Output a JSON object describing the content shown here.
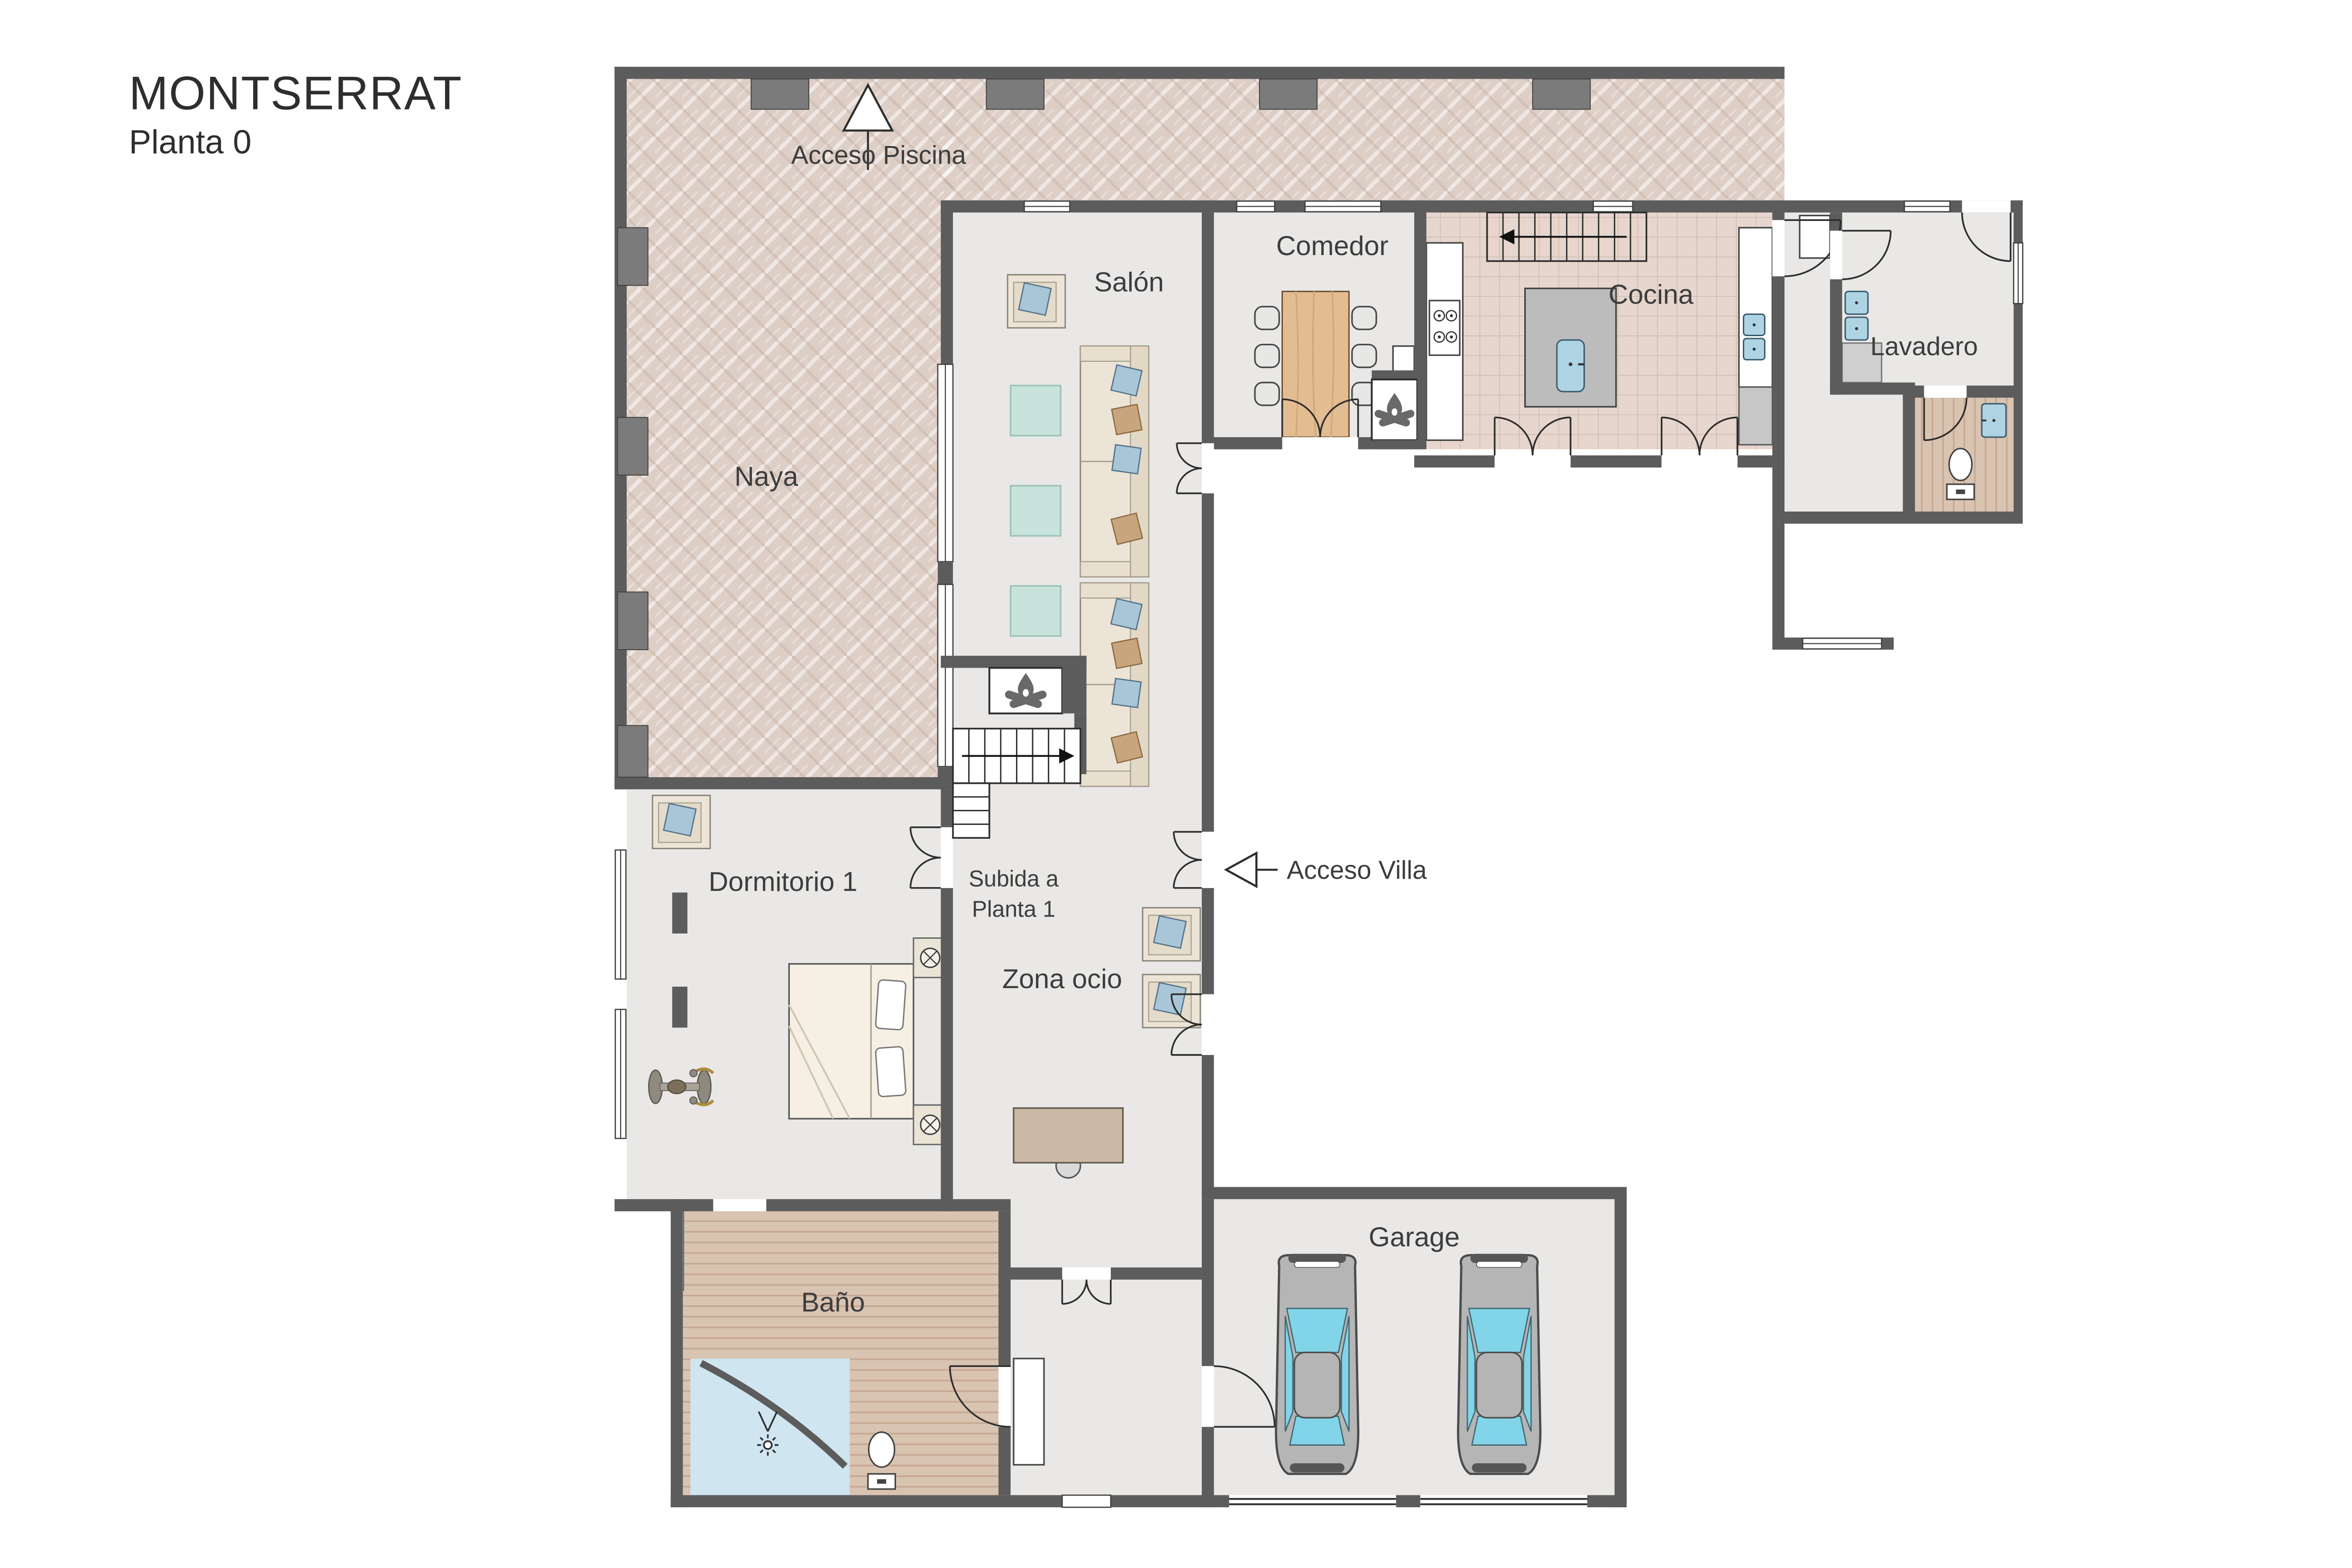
{
  "title": {
    "name": "MONTSERRAT",
    "floor": "Planta 0"
  },
  "rooms": {
    "naya": "Naya",
    "salon": "Salón",
    "comedor": "Comedor",
    "cocina": "Cocina",
    "lavadero": "Lavadero",
    "dormitorio": "Dormitorio 1",
    "zona_ocio": "Zona ocio",
    "bano": "Baño",
    "garage": "Garage"
  },
  "annotations": {
    "acceso_piscina": "Acceso Piscina",
    "acceso_villa": "Acceso Villa",
    "subida_line1": "Subida a",
    "subida_line2": "Planta 1"
  },
  "icons": {
    "up_arrow": "acceso-piscina-arrow",
    "left_arrow": "acceso-villa-arrow",
    "fireplace": "fireplace-icon",
    "stairs": "stairs-icon",
    "car": "car-icon",
    "shower": "shower-icon"
  },
  "colors": {
    "wall": "#5c5c5c",
    "terrace": "#decfc6",
    "floor": "#e9e8e6",
    "kitchen_tile": "#e6d6cd",
    "bath_wood": "#d9c3b1",
    "accent_blue": "#a9c6d8",
    "accent_tan": "#c8a57d",
    "teal": "#c7e3db",
    "car_window": "#82d4e8",
    "table_wood": "#e2bd92",
    "shower_blue": "#cfe5f0"
  }
}
